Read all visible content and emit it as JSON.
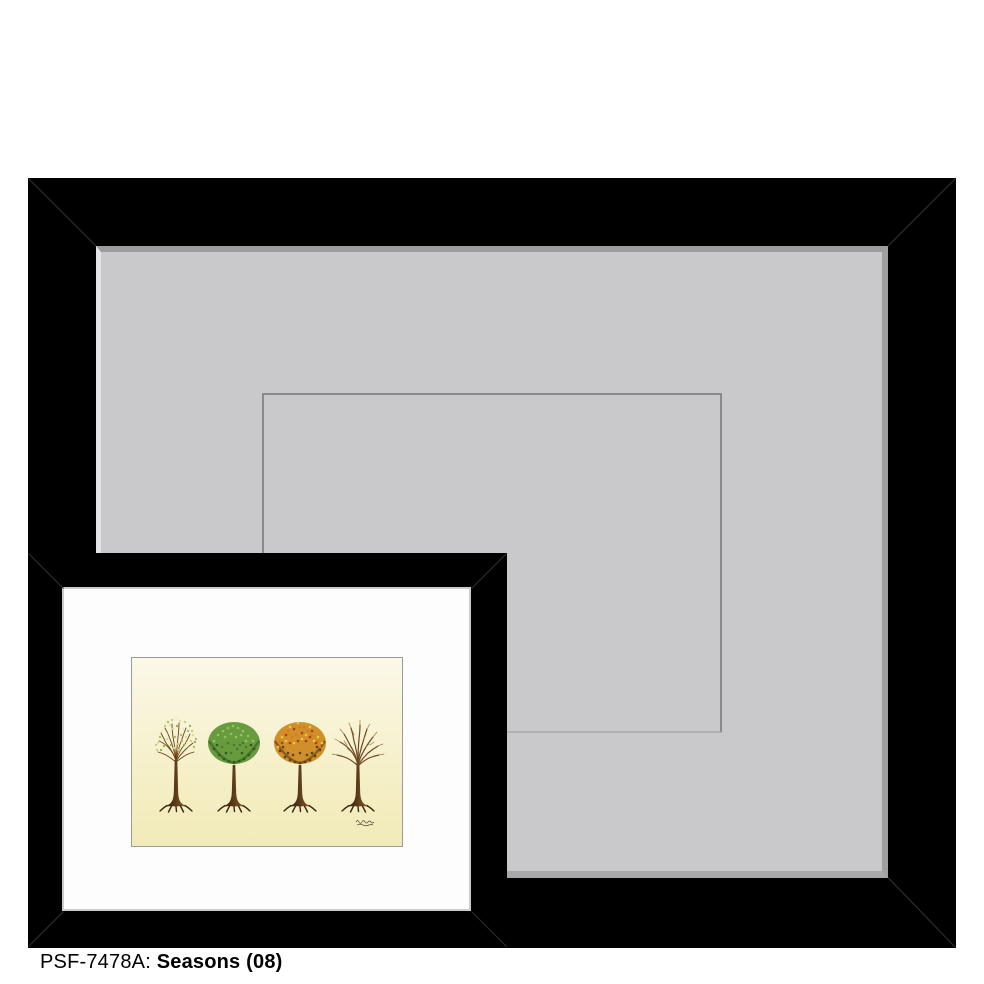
{
  "caption": {
    "sku": "PSF-7478A:",
    "title": "Seasons (08)"
  },
  "colors": {
    "page_background": "#ffffff",
    "frame_black": "#000000",
    "large_mat": "#c9c9cb",
    "mat_opening_line": "#8a8a8c",
    "small_mat_white": "#fdfdfd",
    "art_bg_top": "#fbf8e8",
    "art_bg_upper": "#f8f4d8",
    "art_bg_lower": "#f5efc6",
    "art_bg_bottom": "#f1eab8",
    "trunk_dark": "#2e1f0e",
    "trunk_mid": "#5c3c1a",
    "trunk_light": "#93642e",
    "root_color": "#3a2710",
    "spring_branch": "#6a4018",
    "spring_foliage": "#c6d084",
    "summer_foliage": "#679b3e",
    "autumn_foliage": "#cf8f2a",
    "winter_branch": "#6b4a24",
    "winter_twig": "#9a7a46",
    "signature_ink": "#55503c"
  }
}
